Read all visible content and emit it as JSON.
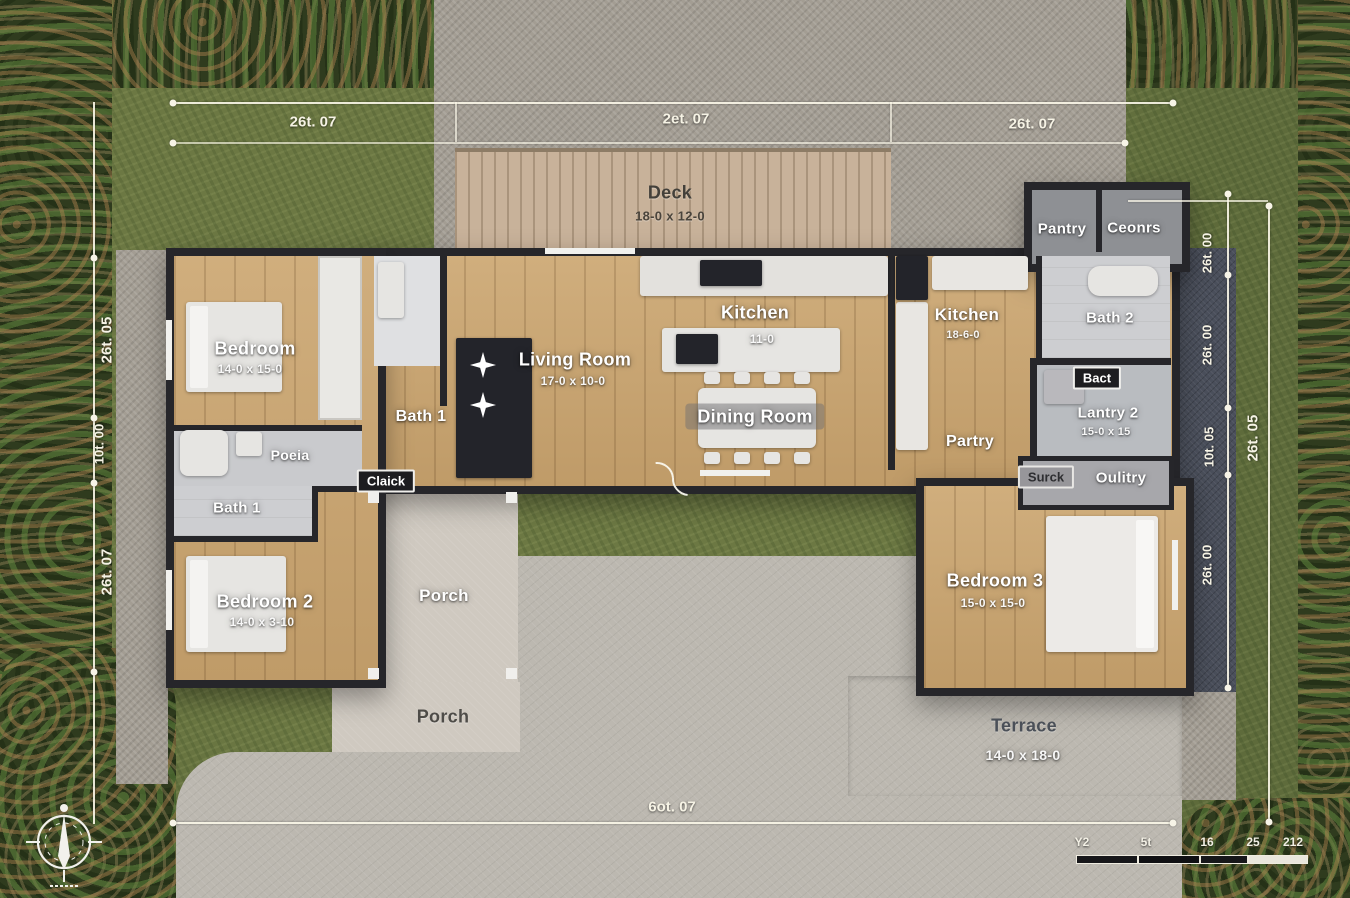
{
  "plan": {
    "dim_top": [
      "26t. 07",
      "2et. 07",
      "26t. 07"
    ],
    "dim_bottom": "6ot. 07",
    "dim_left": [
      "26t. 05",
      "10t. 00",
      "26t. 07"
    ],
    "dim_right_inner": [
      "26t. 00",
      "26t. 00",
      "10t. 05",
      "26t. 00"
    ],
    "dim_right_outer": "26t. 05",
    "rooms": {
      "deck": {
        "name": "Deck",
        "dims": "18-0 x 12-0"
      },
      "bedroom1": {
        "name": "Bedroom",
        "dims": "14-0 x 15-0"
      },
      "bath1_upper": {
        "name": "Bath 1"
      },
      "living": {
        "name": "Living Room",
        "dims": "17-0 x 10-0"
      },
      "kitchen_main": {
        "name": "Kitchen",
        "dims": "11-0"
      },
      "dining": {
        "name": "Dining Room"
      },
      "kitchen2": {
        "name": "Kitchen",
        "dims": "18-6-0"
      },
      "pantry_top": {
        "name": "Pantry"
      },
      "ceonrs": {
        "name": "Ceonrs"
      },
      "bath2": {
        "name": "Bath 2"
      },
      "bact": {
        "name": "Bact"
      },
      "lantry2": {
        "name": "Lantry 2",
        "dims": "15-0 x 15"
      },
      "partry": {
        "name": "Partry"
      },
      "surck": {
        "name": "Surck"
      },
      "oulitry": {
        "name": "Oulitry"
      },
      "poeia": {
        "name": "Poeia"
      },
      "bath1_lower": {
        "name": "Bath 1"
      },
      "claick": {
        "name": "Claick"
      },
      "bedroom2": {
        "name": "Bedroom 2",
        "dims": "14-0 x 3-10"
      },
      "porch1": {
        "name": "Porch"
      },
      "porch2": {
        "name": "Porch"
      },
      "bedroom3": {
        "name": "Bedroom 3",
        "dims": "15-0 x 15-0"
      },
      "terrace": {
        "name": "Terrace",
        "dims": "14-0 x 18-0"
      }
    },
    "scale_bar": [
      "Y2",
      "5t",
      "16",
      "25",
      "212"
    ],
    "colors": {
      "wall": "#26262a",
      "dimline": "#f7f4e7"
    }
  }
}
